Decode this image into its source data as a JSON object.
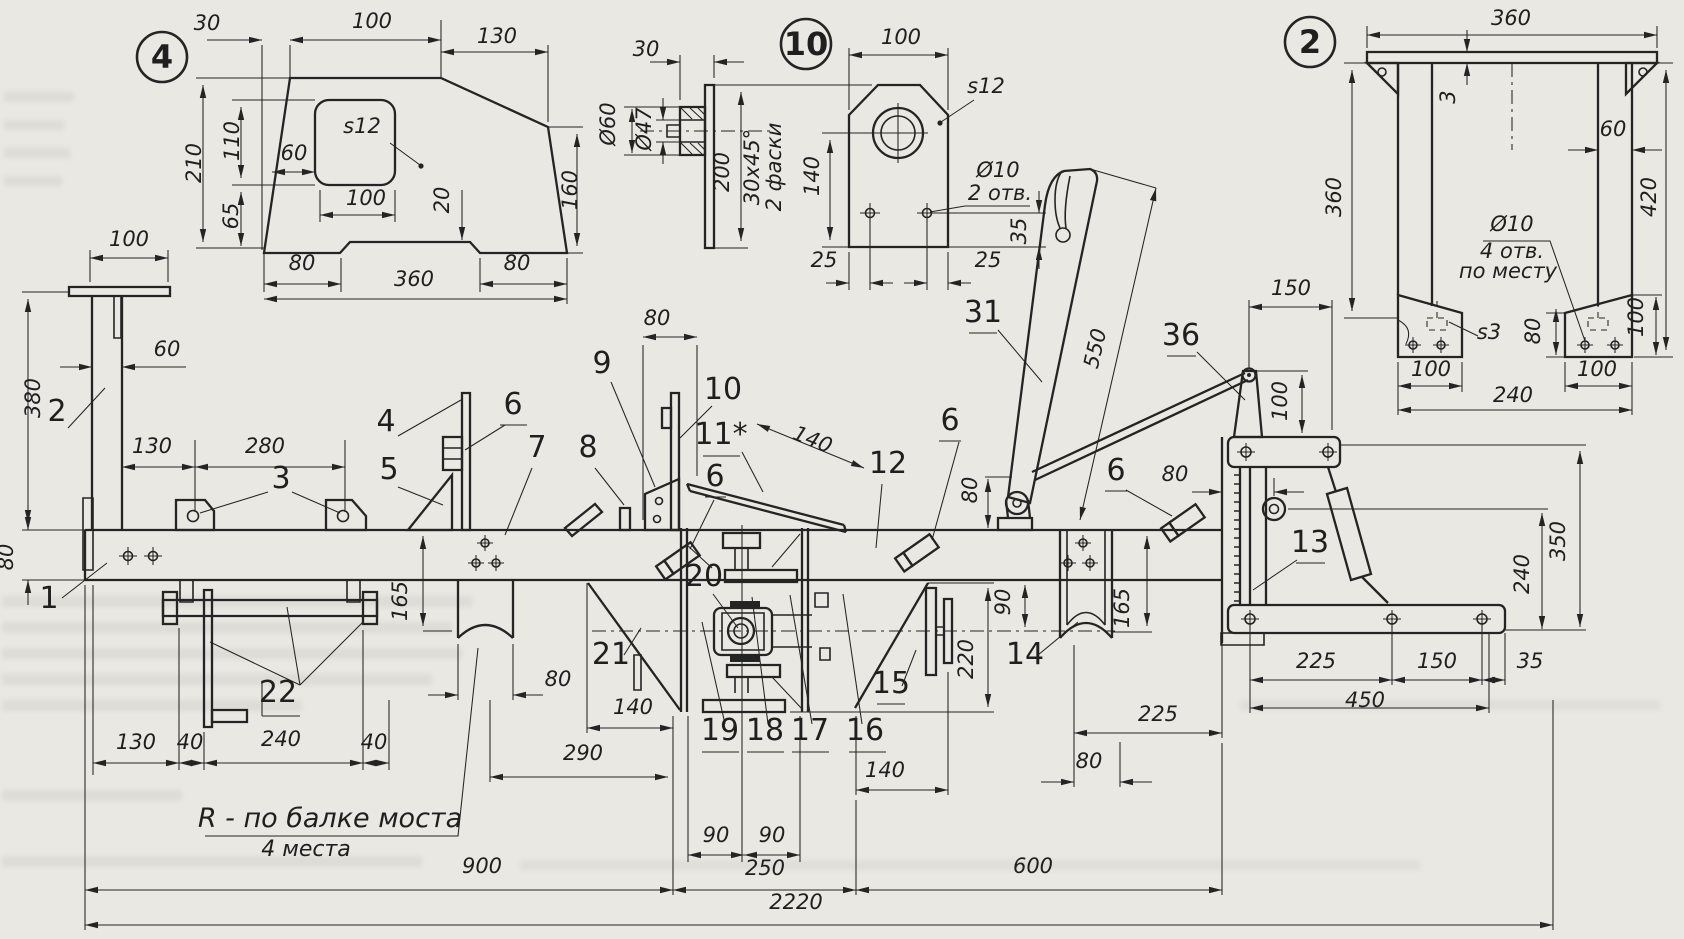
{
  "drawing": {
    "type": "engineering-drawing",
    "language": "ru",
    "paper_color": "#e9e8e2",
    "ink_color": "#242424",
    "notes": {
      "radius_note": "R - по балке моста",
      "radius_note_qty": "4 места",
      "chamfer_note": [
        "30х45°",
        "2 фаски"
      ],
      "holes_note_d10_2": [
        "Ø10",
        "2 отв."
      ],
      "holes_note_d10_4": [
        "Ø10",
        "4 отв.",
        "по месту"
      ],
      "thickness_s12": "s12",
      "thickness_s3": "s3"
    },
    "overall_dimensions": [
      "900",
      "250",
      "600",
      "2220"
    ],
    "part_callouts": [
      "1",
      "2",
      "3",
      "4",
      "5",
      "6",
      "7",
      "8",
      "9",
      "10",
      "11*",
      "12",
      "13",
      "14",
      "15",
      "16",
      "17",
      "18",
      "19",
      "20",
      "21",
      "22",
      "31",
      "36"
    ]
  },
  "balloons": [
    {
      "n": "balloon-detail-4",
      "t": "4",
      "x": 162,
      "y": 57,
      "r": 25
    },
    {
      "n": "balloon-detail-10",
      "t": "10",
      "x": 806,
      "y": 44,
      "r": 25
    },
    {
      "n": "balloon-detail-2",
      "t": "2",
      "x": 1310,
      "y": 42,
      "r": 25
    }
  ],
  "labels": [
    {
      "n": "d4-dim-30",
      "t": "30",
      "x": 207,
      "y": 30
    },
    {
      "n": "d4-dim-100-top",
      "t": "100",
      "x": 372,
      "y": 28
    },
    {
      "n": "d4-dim-130",
      "t": "130",
      "x": 497,
      "y": 43
    },
    {
      "n": "d4-dim-210",
      "t": "210",
      "x": 201,
      "y": 163,
      "r": -90
    },
    {
      "n": "d4-dim-110",
      "t": "110",
      "x": 239,
      "y": 141,
      "r": -90
    },
    {
      "n": "d4-dim-65",
      "t": "65",
      "x": 238,
      "y": 216,
      "r": -90
    },
    {
      "n": "d4-dim-60",
      "t": "60",
      "x": 294,
      "y": 160
    },
    {
      "n": "d4-thickness",
      "t": "s12",
      "x": 362,
      "y": 133
    },
    {
      "n": "d4-dim-100-hole",
      "t": "100",
      "x": 366,
      "y": 205
    },
    {
      "n": "d4-dim-20",
      "t": "20",
      "x": 449,
      "y": 200,
      "r": -90
    },
    {
      "n": "d4-dim-160",
      "t": "160",
      "x": 577,
      "y": 190,
      "r": -90
    },
    {
      "n": "d4-dim-80-left",
      "t": "80",
      "x": 302,
      "y": 270
    },
    {
      "n": "d4-dim-360",
      "t": "360",
      "x": 414,
      "y": 286
    },
    {
      "n": "d4-dim-80-right",
      "t": "80",
      "x": 517,
      "y": 270
    },
    {
      "n": "sv-dim-30",
      "t": "30",
      "x": 646,
      "y": 56
    },
    {
      "n": "sv-dim-d60",
      "t": "Ø60",
      "x": 615,
      "y": 124,
      "r": -90
    },
    {
      "n": "sv-dim-d47",
      "t": "Ø47",
      "x": 651,
      "y": 129,
      "r": -90
    },
    {
      "n": "sv-dim-200",
      "t": "200",
      "x": 729,
      "y": 172,
      "r": -90
    },
    {
      "n": "sv-note-chamfer1",
      "t": "30х45°",
      "x": 759,
      "y": 167,
      "r": -90
    },
    {
      "n": "sv-note-chamfer2",
      "t": "2 фаски",
      "x": 781,
      "y": 167,
      "r": -90
    },
    {
      "n": "d10-dim-100",
      "t": "100",
      "x": 901,
      "y": 44
    },
    {
      "n": "d10-thickness",
      "t": "s12",
      "x": 986,
      "y": 93
    },
    {
      "n": "d10-dim-140",
      "t": "140",
      "x": 819,
      "y": 176,
      "r": -90
    },
    {
      "n": "d10-note-d10",
      "t": "Ø10",
      "x": 998,
      "y": 177
    },
    {
      "n": "d10-note-2otv",
      "t": "2 отв.",
      "x": 1000,
      "y": 200
    },
    {
      "n": "d10-dim-35",
      "t": "35",
      "x": 1026,
      "y": 231,
      "r": -90
    },
    {
      "n": "d10-dim-25l",
      "t": "25",
      "x": 824,
      "y": 267
    },
    {
      "n": "d10-dim-25r",
      "t": "25",
      "x": 988,
      "y": 267
    },
    {
      "n": "d2-dim-360-top",
      "t": "360",
      "x": 1511,
      "y": 25
    },
    {
      "n": "d2-dim-3",
      "t": "3",
      "x": 1455,
      "y": 97,
      "r": -90
    },
    {
      "n": "d2-dim-60",
      "t": "60",
      "x": 1613,
      "y": 136
    },
    {
      "n": "d2-dim-360-left",
      "t": "360",
      "x": 1341,
      "y": 197,
      "r": -90
    },
    {
      "n": "d2-dim-420",
      "t": "420",
      "x": 1656,
      "y": 197,
      "r": -90
    },
    {
      "n": "d2-note-d10",
      "t": "Ø10",
      "x": 1512,
      "y": 231
    },
    {
      "n": "d2-note-4otv",
      "t": "4 отв.",
      "x": 1512,
      "y": 258
    },
    {
      "n": "d2-note-pomestu",
      "t": "по месту",
      "x": 1508,
      "y": 278
    },
    {
      "n": "d2-thickness",
      "t": "s3",
      "x": 1489,
      "y": 339
    },
    {
      "n": "d2-dim-80",
      "t": "80",
      "x": 1540,
      "y": 331,
      "r": -90
    },
    {
      "n": "d2-dim-100-right",
      "t": "100",
      "x": 1643,
      "y": 317,
      "r": -90
    },
    {
      "n": "d2-dim-100-footl",
      "t": "100",
      "x": 1431,
      "y": 376
    },
    {
      "n": "d2-dim-100-footr",
      "t": "100",
      "x": 1597,
      "y": 376
    },
    {
      "n": "d2-dim-240",
      "t": "240",
      "x": 1513,
      "y": 402
    },
    {
      "n": "m-dim-100-plate",
      "t": "100",
      "x": 129,
      "y": 246
    },
    {
      "n": "m-dim-60",
      "t": "60",
      "x": 167,
      "y": 356
    },
    {
      "n": "m-dim-380",
      "t": "380",
      "x": 40,
      "y": 398,
      "r": -90
    },
    {
      "n": "m-callout-2",
      "t": "2",
      "x": 57,
      "y": 421,
      "c": 1
    },
    {
      "n": "m-dim-80-beam",
      "t": "80",
      "x": 13,
      "y": 557,
      "r": -90
    },
    {
      "n": "m-callout-1",
      "t": "1",
      "x": 49,
      "y": 608,
      "c": 1
    },
    {
      "n": "m-dim-130",
      "t": "130",
      "x": 152,
      "y": 453
    },
    {
      "n": "m-dim-280",
      "t": "280",
      "x": 265,
      "y": 453
    },
    {
      "n": "m-callout-3",
      "t": "3",
      "x": 281,
      "y": 488,
      "c": 1
    },
    {
      "n": "m-callout-4",
      "t": "4",
      "x": 386,
      "y": 431,
      "c": 1
    },
    {
      "n": "m-callout-6a",
      "t": "6",
      "x": 513,
      "y": 414,
      "c": 1
    },
    {
      "n": "m-callout-5",
      "t": "5",
      "x": 389,
      "y": 479,
      "c": 1
    },
    {
      "n": "m-callout-7",
      "t": "7",
      "x": 537,
      "y": 457,
      "c": 1
    },
    {
      "n": "m-callout-8",
      "t": "8",
      "x": 588,
      "y": 457,
      "c": 1
    },
    {
      "n": "m-callout-9",
      "t": "9",
      "x": 602,
      "y": 373,
      "c": 1
    },
    {
      "n": "m-dim-80-bar10",
      "t": "80",
      "x": 657,
      "y": 325
    },
    {
      "n": "m-callout-10",
      "t": "10",
      "x": 723,
      "y": 399,
      "c": 1
    },
    {
      "n": "m-callout-11",
      "t": "11*",
      "x": 721,
      "y": 444,
      "c": 1
    },
    {
      "n": "m-callout-6b",
      "t": "6",
      "x": 715,
      "y": 486,
      "c": 1
    },
    {
      "n": "m-dim-140-blade",
      "t": "140",
      "x": 810,
      "y": 446,
      "r": 22
    },
    {
      "n": "m-callout-12",
      "t": "12",
      "x": 888,
      "y": 473,
      "c": 1
    },
    {
      "n": "m-callout-6c",
      "t": "6",
      "x": 950,
      "y": 430,
      "c": 1
    },
    {
      "n": "m-callout-31",
      "t": "31",
      "x": 983,
      "y": 322,
      "c": 1
    },
    {
      "n": "m-dim-550",
      "t": "550",
      "x": 1102,
      "y": 350,
      "r": -77
    },
    {
      "n": "m-callout-36",
      "t": "36",
      "x": 1181,
      "y": 345,
      "c": 1
    },
    {
      "n": "m-dim-150-lever",
      "t": "150",
      "x": 1291,
      "y": 295
    },
    {
      "n": "m-dim-100-bracket",
      "t": "100",
      "x": 1287,
      "y": 401,
      "r": -90
    },
    {
      "n": "m-dim-80-pivot",
      "t": "80",
      "x": 977,
      "y": 490,
      "r": -90
    },
    {
      "n": "m-callout-6d",
      "t": "6",
      "x": 1116,
      "y": 480,
      "c": 1
    },
    {
      "n": "m-dim-80-rack",
      "t": "80",
      "x": 1175,
      "y": 481
    },
    {
      "n": "m-callout-13",
      "t": "13",
      "x": 1310,
      "y": 552,
      "c": 1
    },
    {
      "n": "m-dim-165-left",
      "t": "165",
      "x": 407,
      "y": 601,
      "r": -90
    },
    {
      "n": "m-callout-20",
      "t": "20",
      "x": 704,
      "y": 586,
      "c": 1
    },
    {
      "n": "m-callout-21",
      "t": "21",
      "x": 611,
      "y": 664,
      "c": 1
    },
    {
      "n": "m-callout-15",
      "t": "15",
      "x": 891,
      "y": 693,
      "c": 1
    },
    {
      "n": "m-dim-90-axis",
      "t": "90",
      "x": 1010,
      "y": 602,
      "r": -90
    },
    {
      "n": "m-dim-220",
      "t": "220",
      "x": 973,
      "y": 659,
      "r": -90
    },
    {
      "n": "m-callout-14",
      "t": "14",
      "x": 1025,
      "y": 664,
      "c": 1
    },
    {
      "n": "m-dim-165-right",
      "t": "165",
      "x": 1129,
      "y": 608,
      "r": -90
    },
    {
      "n": "m-dim-80-saddle",
      "t": "80",
      "x": 558,
      "y": 686
    },
    {
      "n": "m-dim-140-left",
      "t": "140",
      "x": 633,
      "y": 714
    },
    {
      "n": "m-callout-19",
      "t": "19",
      "x": 720,
      "y": 740,
      "c": 1
    },
    {
      "n": "m-callout-18",
      "t": "18",
      "x": 765,
      "y": 740,
      "c": 1
    },
    {
      "n": "m-callout-17",
      "t": "17",
      "x": 810,
      "y": 740,
      "c": 1
    },
    {
      "n": "m-callout-16",
      "t": "16",
      "x": 865,
      "y": 740,
      "c": 1
    },
    {
      "n": "m-callout-22",
      "t": "22",
      "x": 278,
      "y": 702,
      "c": 1
    },
    {
      "n": "m-dim-130b",
      "t": "130",
      "x": 136,
      "y": 749
    },
    {
      "n": "m-dim-40a",
      "t": "40",
      "x": 190,
      "y": 749
    },
    {
      "n": "m-dim-240b",
      "t": "240",
      "x": 281,
      "y": 746
    },
    {
      "n": "m-dim-40b",
      "t": "40",
      "x": 374,
      "y": 749
    },
    {
      "n": "m-dim-90a",
      "t": "90",
      "x": 716,
      "y": 842
    },
    {
      "n": "m-dim-90b",
      "t": "90",
      "x": 772,
      "y": 842
    },
    {
      "n": "m-dim-290",
      "t": "290",
      "x": 583,
      "y": 760
    },
    {
      "n": "m-dim-140-right",
      "t": "140",
      "x": 885,
      "y": 777
    },
    {
      "n": "m-dim-225-mid",
      "t": "225",
      "x": 1158,
      "y": 721
    },
    {
      "n": "m-dim-80-mid",
      "t": "80",
      "x": 1089,
      "y": 768
    },
    {
      "n": "m-note-radius",
      "t": "R - по балке моста",
      "x": 330,
      "y": 827,
      "s": 27
    },
    {
      "n": "m-note-radius-qty",
      "t": "4 места",
      "x": 306,
      "y": 856,
      "s": 22
    },
    {
      "n": "m-dim-900",
      "t": "900",
      "x": 482,
      "y": 873
    },
    {
      "n": "m-dim-250",
      "t": "250",
      "x": 765,
      "y": 875
    },
    {
      "n": "m-dim-600",
      "t": "600",
      "x": 1033,
      "y": 873
    },
    {
      "n": "m-dim-2220",
      "t": "2220",
      "x": 796,
      "y": 909
    },
    {
      "n": "m-dim-225-base",
      "t": "225",
      "x": 1316,
      "y": 668
    },
    {
      "n": "m-dim-150-base",
      "t": "150",
      "x": 1437,
      "y": 668
    },
    {
      "n": "m-dim-35-base",
      "t": "35",
      "x": 1530,
      "y": 668
    },
    {
      "n": "m-dim-450",
      "t": "450",
      "x": 1365,
      "y": 707
    },
    {
      "n": "m-dim-350",
      "t": "350",
      "x": 1565,
      "y": 541,
      "r": -90
    },
    {
      "n": "m-dim-240-right",
      "t": "240",
      "x": 1529,
      "y": 574,
      "r": -90
    }
  ]
}
